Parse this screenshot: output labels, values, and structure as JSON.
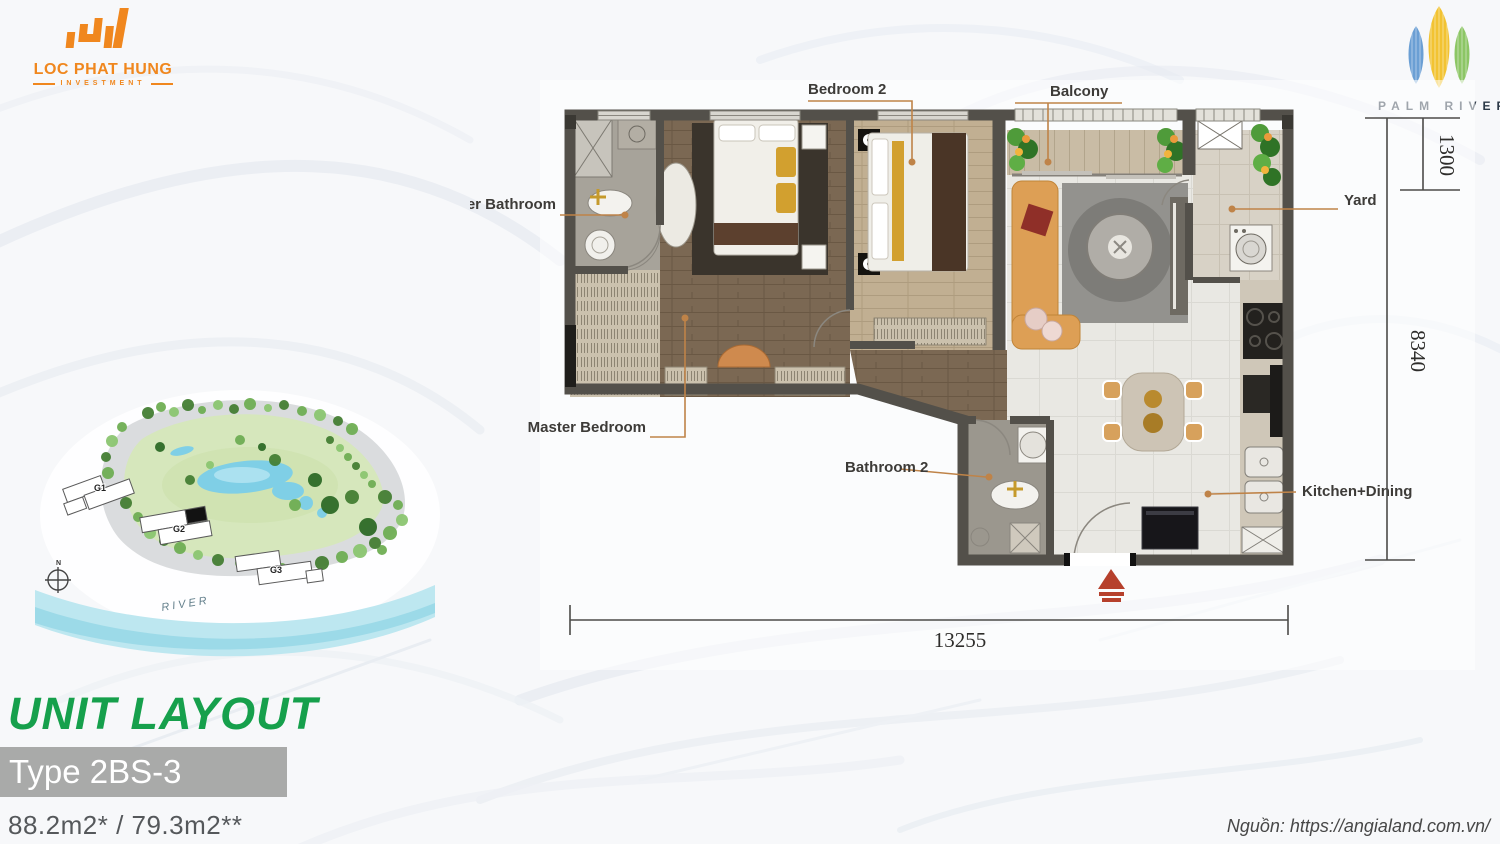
{
  "header": {
    "lph_logo": {
      "line1": "LOC PHAT HUNG",
      "line2": "INVESTMENT"
    },
    "palm_logo": {
      "name": "PALM RIVER"
    }
  },
  "floor_plan": {
    "labels": {
      "bedroom2": "Bedroom 2",
      "balcony": "Balcony",
      "master_bathroom": "Master Bathroom",
      "yard": "Yard",
      "master_bedroom": "Master Bedroom",
      "bathroom2": "Bathroom 2",
      "kitchen_dining": "Kitchen+Dining"
    },
    "dimensions": {
      "top_right": "1300",
      "right": "8340",
      "bottom": "13255"
    }
  },
  "site_plan": {
    "buildings": [
      "G1",
      "G2",
      "G3"
    ],
    "river_label": "RIVER",
    "compass": "N"
  },
  "footer": {
    "title": "UNIT LAYOUT",
    "type_label": "Type 2BS-3",
    "areas": "88.2m2* / 79.3m2**",
    "source": "Nguồn: https://angialand.com.vn/"
  },
  "colors": {
    "accent_green": "#16a04c",
    "logo_orange": "#f0871e",
    "leader_line": "#bf8348",
    "entrance_marker": "#b6402c",
    "type_bar_gray": "#a9aaa9"
  }
}
